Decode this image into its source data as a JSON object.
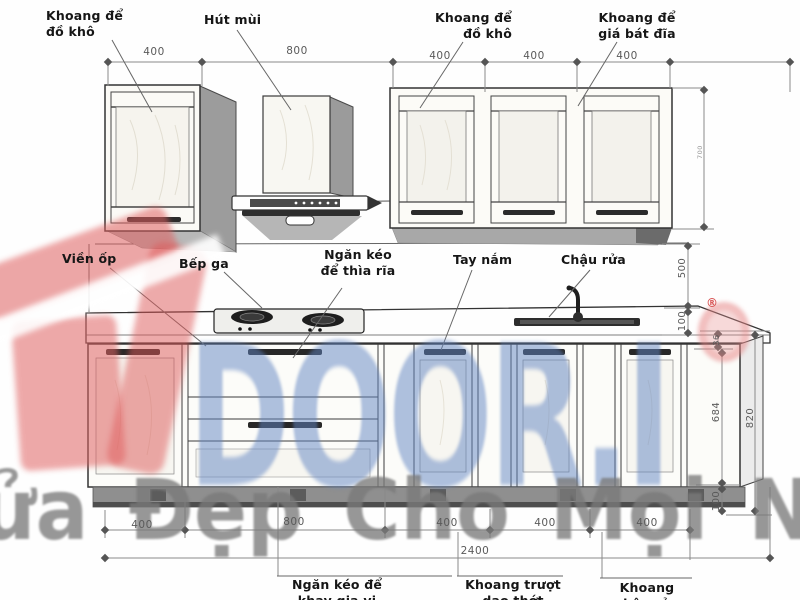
{
  "drawing_title": "kitchen cabinet elevation drawing",
  "callouts": {
    "top": [
      {
        "text": "Khoang để\nđồ khô"
      },
      {
        "text": "Hút mùi"
      },
      {
        "text": "Khoang để\nđồ khô"
      },
      {
        "text": "Khoang để\ngiá bát đĩa"
      }
    ],
    "middle": [
      {
        "text": "Viền ốp"
      },
      {
        "text": "Bếp ga"
      },
      {
        "text": "Ngăn kéo\nđể thìa rĩa"
      },
      {
        "text": "Tay nắm"
      },
      {
        "text": "Chậu rửa"
      }
    ],
    "bottom": [
      {
        "text": "Ngăn kéo để\nkhay gia vị"
      },
      {
        "text": "Khoang trượt\ndao thớt"
      },
      {
        "text": "Khoang\nchậu rửa"
      }
    ]
  },
  "dimensions": {
    "top_row": [
      "400",
      "800",
      "400",
      "400",
      "400"
    ],
    "bottom_row": [
      "400",
      "800",
      "400",
      "400",
      "400"
    ],
    "total_width": "2400",
    "right_column": {
      "upper_cabinet_height": "700",
      "backsplash_height": "500",
      "splash_gap": "100",
      "countertop_thickness": "36",
      "base_front_height": "684",
      "base_total_height": "820",
      "plinth_height": "100"
    }
  },
  "watermarks": {
    "brand_text": "DOOR.I",
    "slogan": "ửa Đẹp Cho Mọi Nh",
    "registered_mark": "®",
    "brand_color": "#6084c2",
    "slogan_color": "#7a7a7a",
    "logo_color": "#df5f5f"
  }
}
